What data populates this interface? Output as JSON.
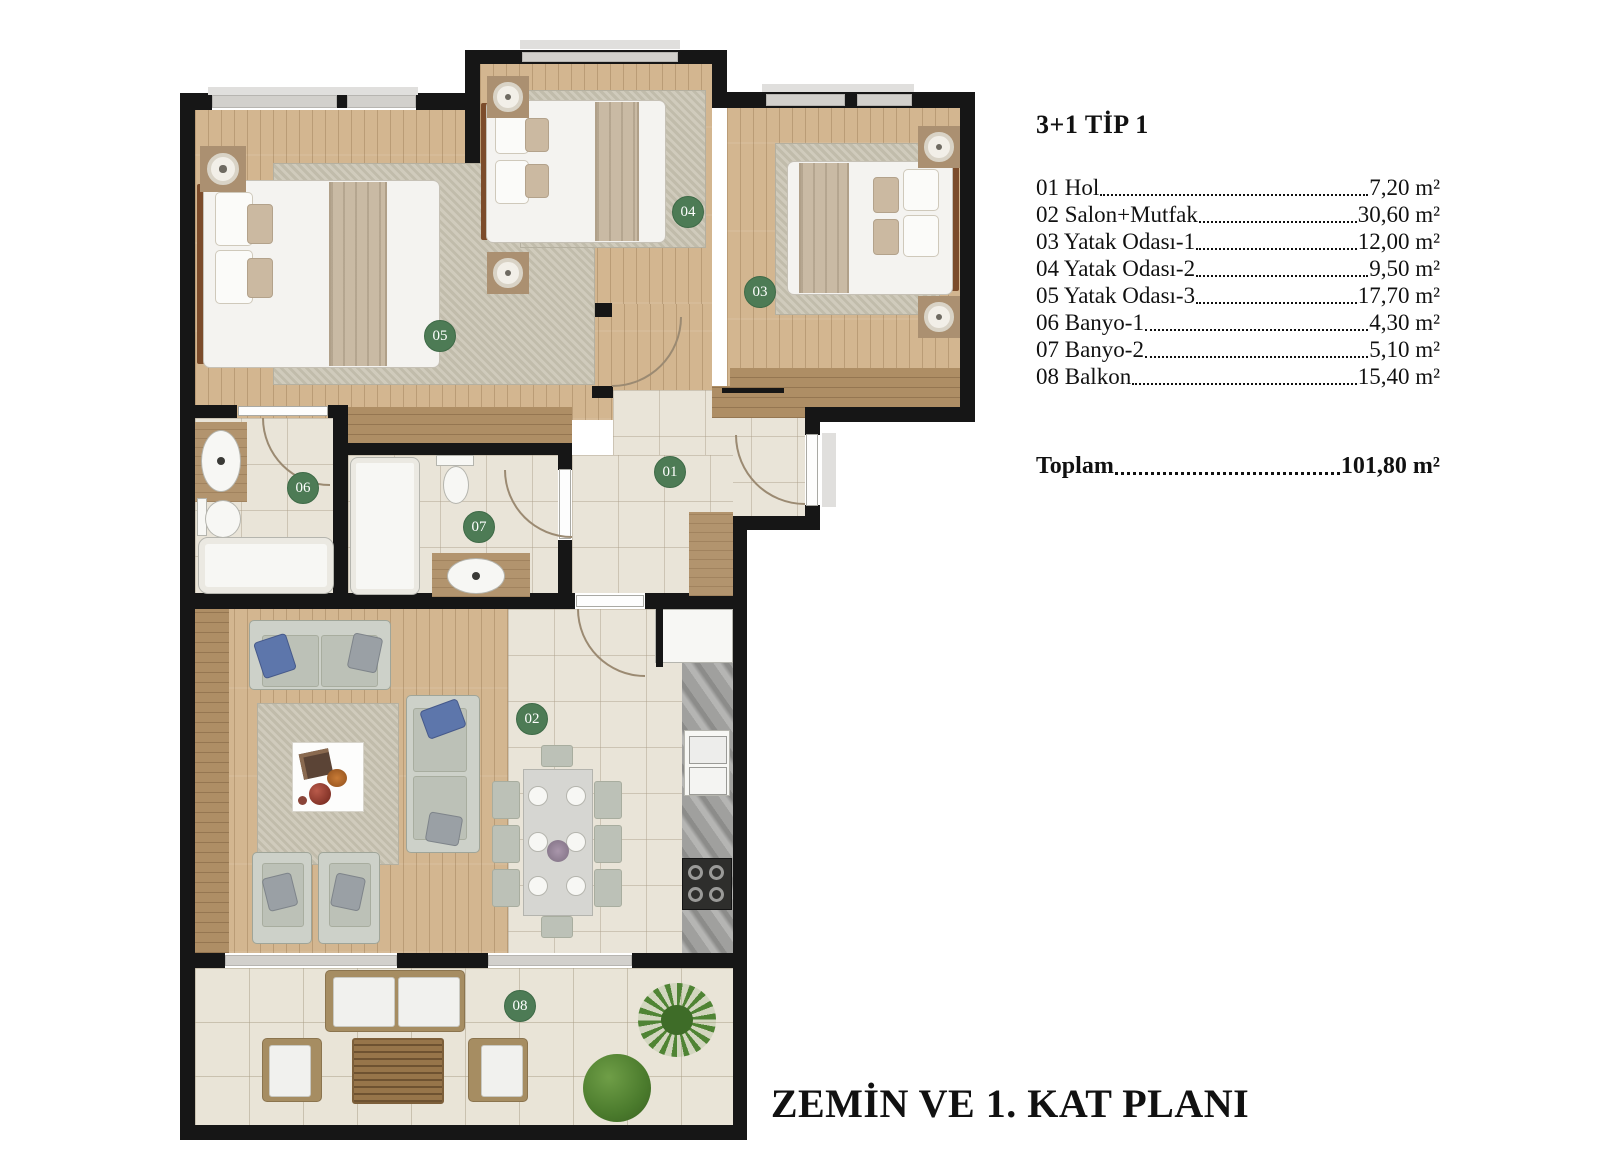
{
  "legend": {
    "title": "3+1 TİP 1",
    "items": [
      {
        "label": "01 Hol",
        "value": "7,20 m²"
      },
      {
        "label": "02 Salon+Mutfak",
        "value": "30,60 m²"
      },
      {
        "label": "03 Yatak Odası-1",
        "value": "12,00 m²"
      },
      {
        "label": "04 Yatak Odası-2",
        "value": "9,50 m²"
      },
      {
        "label": "05 Yatak Odası-3",
        "value": "17,70 m²"
      },
      {
        "label": "06 Banyo-1",
        "value": "4,30 m²"
      },
      {
        "label": "07 Banyo-2",
        "value": "5,10 m²"
      },
      {
        "label": "08 Balkon",
        "value": "15,40 m²"
      }
    ],
    "total_label": "Toplam",
    "total_value": "101,80 m²"
  },
  "plan": {
    "title": "ZEMİN VE 1. KAT PLANI",
    "markers": [
      {
        "label": "01"
      },
      {
        "label": "02"
      },
      {
        "label": "03"
      },
      {
        "label": "04"
      },
      {
        "label": "05"
      },
      {
        "label": "06"
      },
      {
        "label": "07"
      },
      {
        "label": "08"
      }
    ],
    "colors": {
      "marker_green": "#4d7b55",
      "wall_black": "#161616",
      "wood_floor": "#d3b690",
      "dark_wood": "#ae8e65",
      "tile": "#e9e4d8",
      "marble_counter": "#a0a09e",
      "accent_blue_pillow": "#5d76ab"
    }
  }
}
